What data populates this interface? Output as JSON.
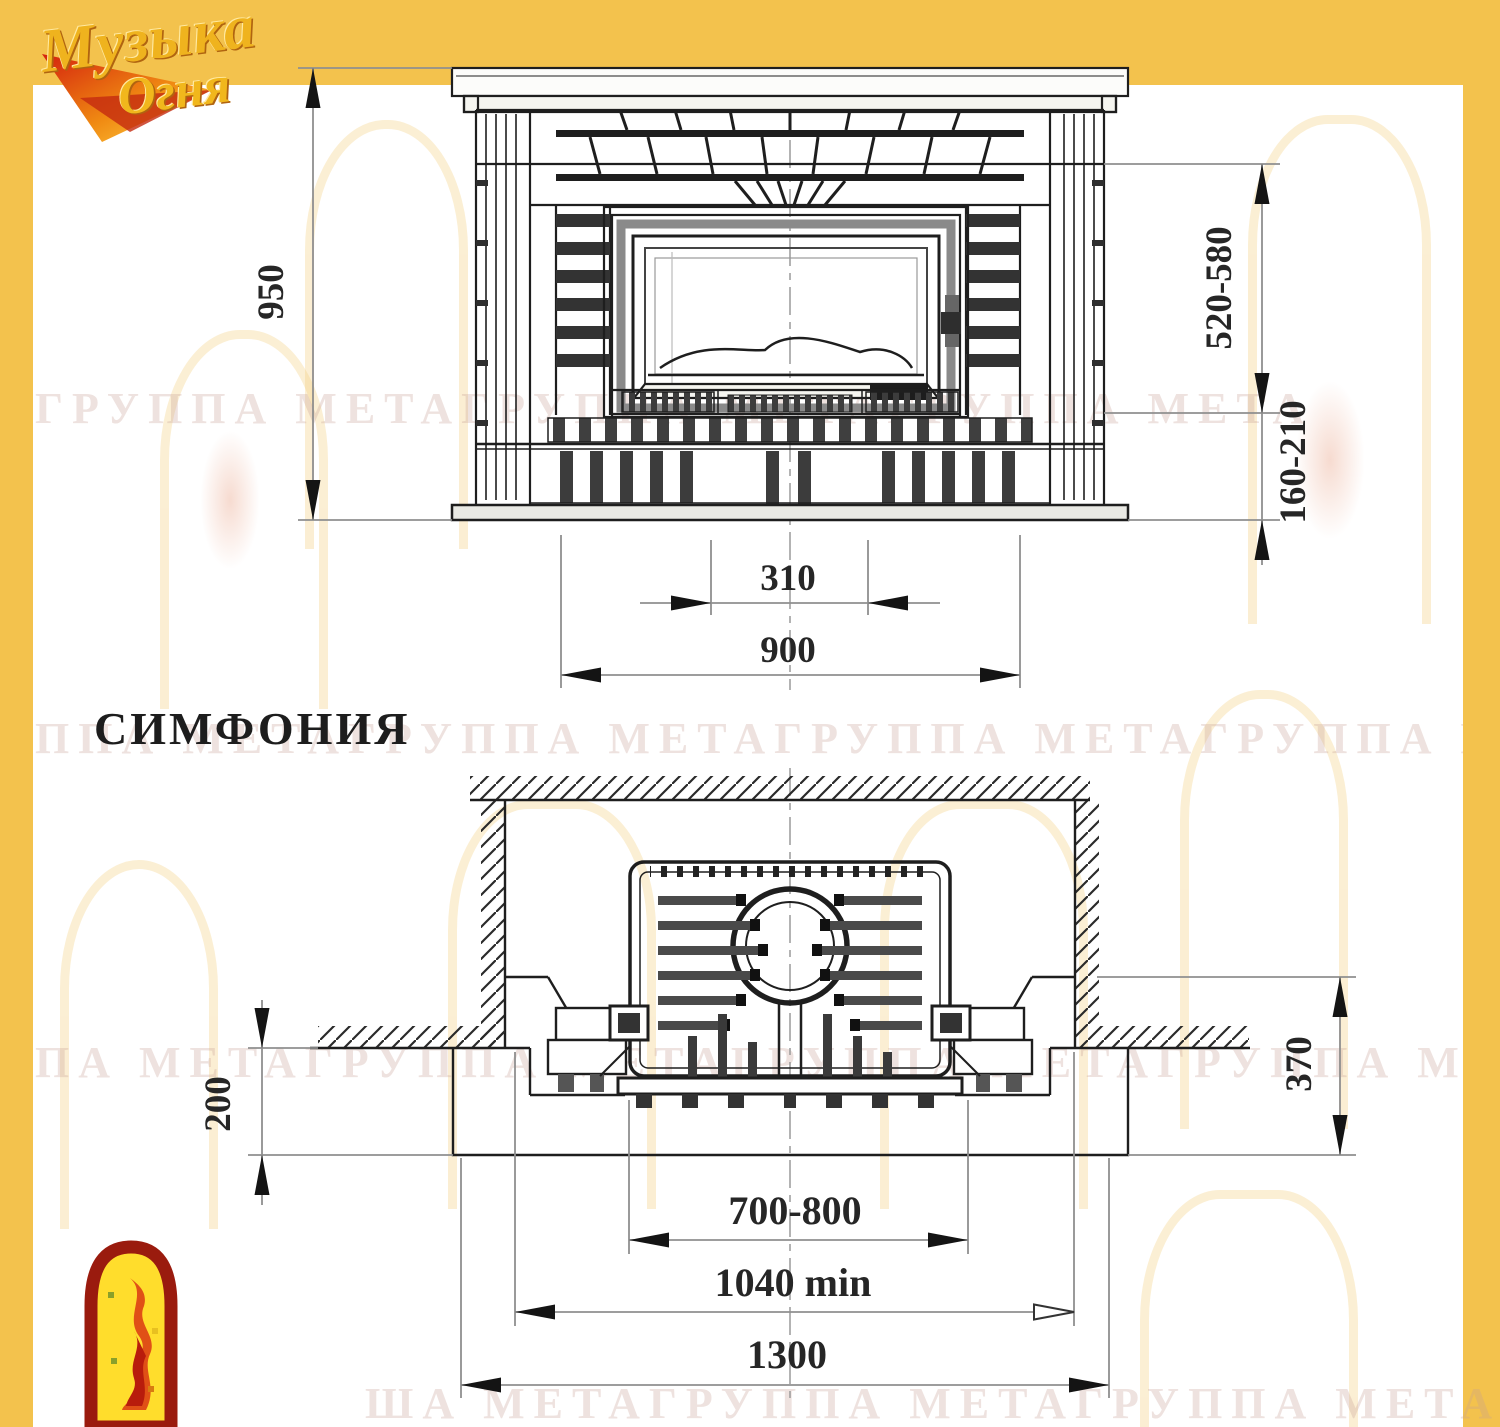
{
  "page": {
    "accent_yellow": "#F3C24D",
    "line_color": "#1e1e1e",
    "dim_line_color": "#8f8f8f"
  },
  "logo": {
    "word1": "Музыка",
    "word2": "Огня"
  },
  "title": "СИМФОНИЯ",
  "front_view": {
    "dims": {
      "height": "950",
      "firebox_zone": "520-580",
      "plinth_zone": "160-210",
      "inner_width": "310",
      "hearth_width": "900"
    }
  },
  "plan_view": {
    "dims": {
      "base_offset": "200",
      "portal_depth": "370",
      "insert_width": "700-800",
      "niche_width": "1040 min",
      "overall_width": "1300"
    }
  },
  "watermarks": {
    "row1": "ГРУППА МЕТАГРУППА МЕТАГРУППА МЕТА",
    "row2": "ППА МЕТАГРУППА МЕТАГРУППА МЕТАГРУППА МЕТА",
    "row3": "ПА МЕТАГРУППА МЕТАГРУППА МЕТАГРУППА МЕ",
    "row4": "ША МЕТАГРУППА МЕТАГРУППА МЕТАГРУППА МЕТА"
  }
}
